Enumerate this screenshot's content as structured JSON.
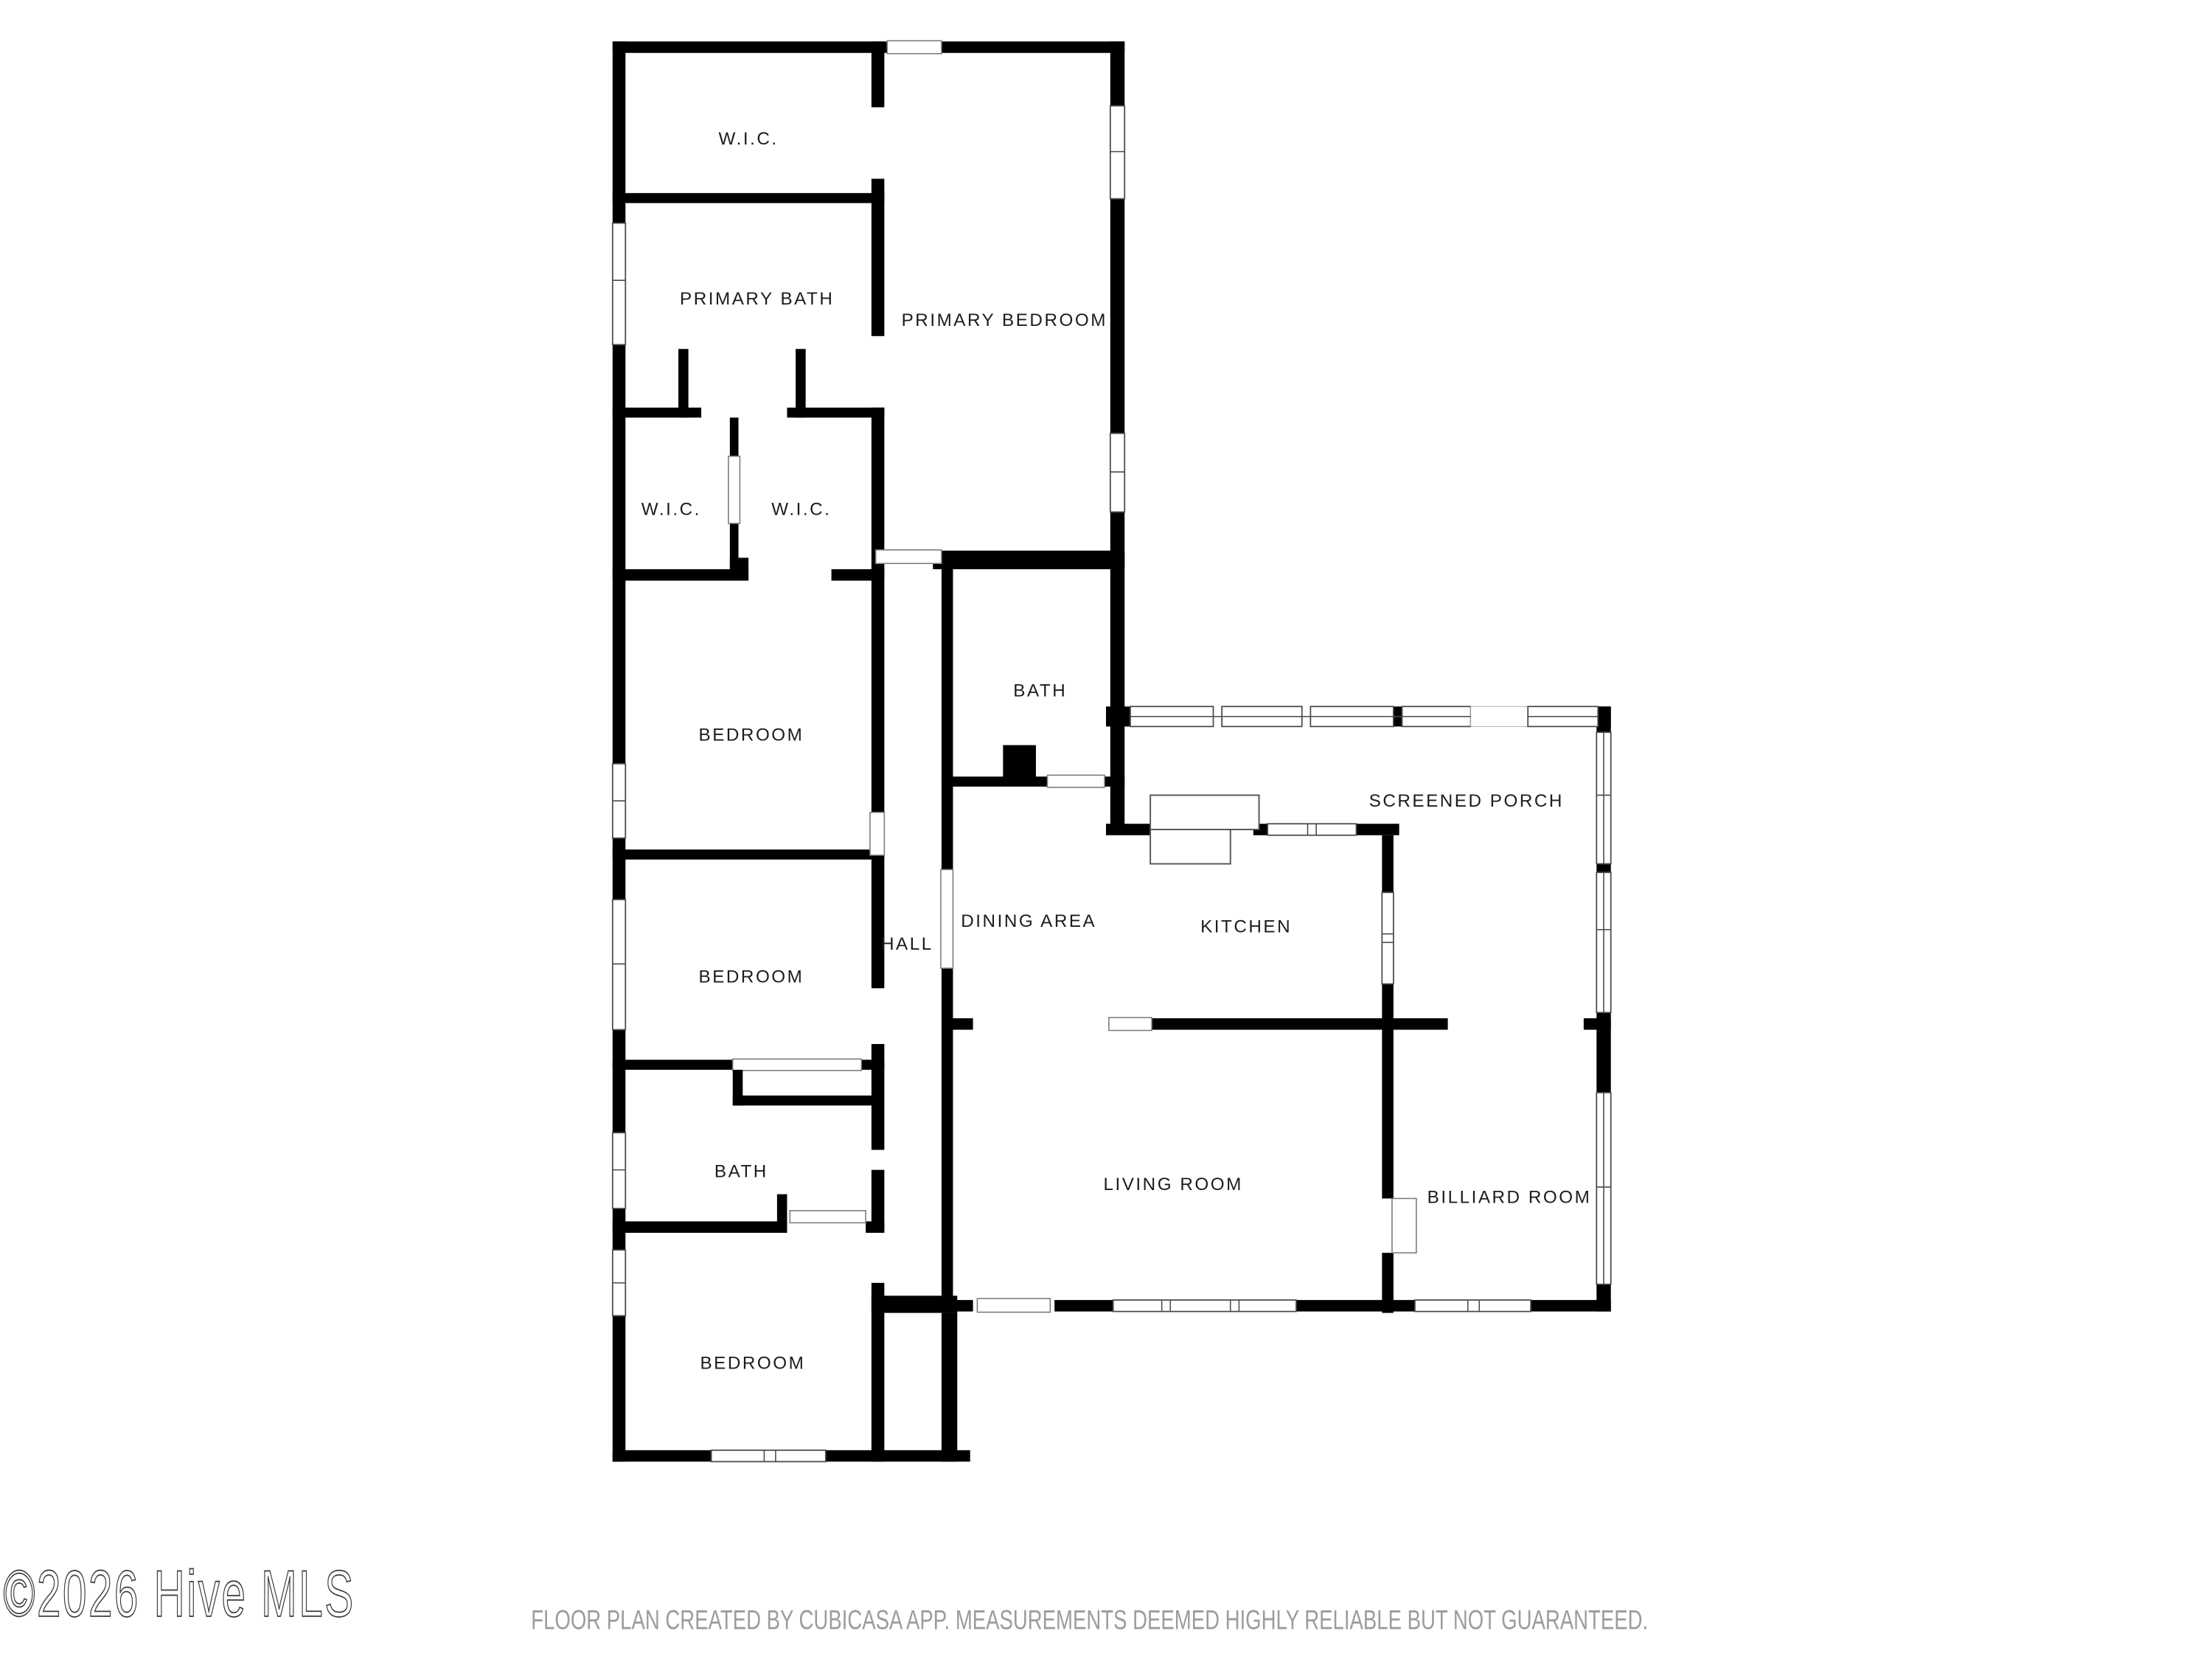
{
  "rooms": [
    {
      "id": "wic-top",
      "label": "W.I.C."
    },
    {
      "id": "primary-bath",
      "label": "PRIMARY BATH"
    },
    {
      "id": "primary-bedroom",
      "label": "PRIMARY BEDROOM"
    },
    {
      "id": "wic-left",
      "label": "W.I.C."
    },
    {
      "id": "wic-right",
      "label": "W.I.C."
    },
    {
      "id": "bedroom-1",
      "label": "BEDROOM"
    },
    {
      "id": "bath-middle",
      "label": "BATH"
    },
    {
      "id": "screened-porch",
      "label": "SCREENED PORCH"
    },
    {
      "id": "dining-area",
      "label": "DINING AREA"
    },
    {
      "id": "kitchen",
      "label": "KITCHEN"
    },
    {
      "id": "hall",
      "label": "HALL"
    },
    {
      "id": "bedroom-2",
      "label": "BEDROOM"
    },
    {
      "id": "bath-2",
      "label": "BATH"
    },
    {
      "id": "living-room",
      "label": "LIVING ROOM"
    },
    {
      "id": "billiard-room",
      "label": "BILLIARD ROOM"
    },
    {
      "id": "bedroom-3",
      "label": "BEDROOM"
    }
  ],
  "watermark": "©2026 Hive MLS",
  "footer": "FLOOR PLAN CREATED BY CUBICASA APP. MEASUREMENTS DEEMED HIGHLY RELIABLE BUT NOT GUARANTEED.",
  "colors": {
    "wall": "#000000",
    "window_frame": "#4a4a4a",
    "label": "#1c1c1c",
    "footer": "#9c9c9c",
    "watermark": "#3a3a3a",
    "background": "#ffffff"
  }
}
